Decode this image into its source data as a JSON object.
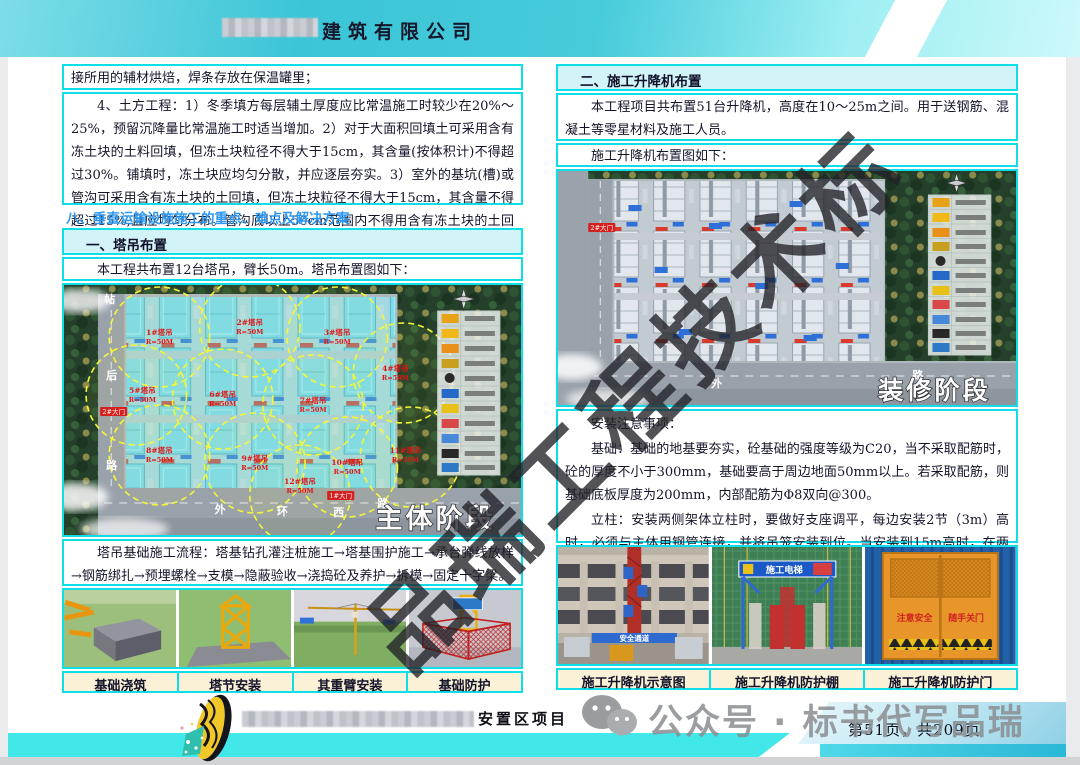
{
  "header": {
    "company": "建筑有限公司"
  },
  "watermarks": {
    "diagonal": "品瑞工程技术标",
    "wechat": "公众号 · 标书代写品瑞"
  },
  "footer": {
    "project": "安置区项目",
    "page_info": "第51页，共209页"
  },
  "left_page": {
    "para_weld": "接所用的辅材烘焙，焊条存放在保温罐里；",
    "para_earthwork": "4、土方工程：1）冬季填方每层辅土厚度应比常温施工时较少在20%～25%，预留沉降量比常温施工时适当增加。2）对于大面积回填土可采用含有冻土块的土料回填，但冻土块粒径不得大于15cm，其含量(按体积计)不得超过30%。铺填时，冻土块应均匀分散，并应逐层夯实。3）室外的基坑(槽)或管沟可采用含有冻土块的土回填，但冻土块粒径不得大于15cm，其含量不得超过15%,且应均匀分布。管沟底以上50cm范围内不得用含有冻土块的土回填。",
    "chapter_heading": "八、垂直运输设施施工的重点、难点及解决方案",
    "section_title": "一、塔吊布置",
    "section_intro": "本工程共布置12台塔吊，臂长50m。塔吊布置图如下：",
    "flow_text": "塔吊基础施工流程：塔基钻孔灌注桩施工→塔基围护施工→承台弹线放样→钢筋绑扎→预埋螺栓→支模→隐蔽验收→浇捣砼及养护→拆模→固定十字梁。",
    "photo_captions": [
      "基础浇筑",
      "塔节安装",
      "其重臂安装",
      "基础防护"
    ],
    "plan": {
      "stage_label": "主体阶段",
      "crane_radius": "R=50M",
      "cranes": [
        "1#塔吊",
        "2#塔吊",
        "3#塔吊",
        "4#塔吊",
        "5#塔吊",
        "6#塔吊",
        "7#塔吊",
        "8#塔吊",
        "9#塔吊",
        "10#塔吊",
        "11#塔吊",
        "12#塔吊"
      ],
      "gates": [
        "2#大门",
        "1#大门"
      ],
      "roads": {
        "r1": "帖",
        "r2": "后",
        "r3": "路",
        "r4": "外",
        "r5": "环",
        "r6": "西",
        "r7": "路"
      }
    }
  },
  "right_page": {
    "section_title": "二、施工升降机布置",
    "section_intro": "本工程项目共布置51台升降机，高度在10～25m之间。用于送钢筋、混凝土等零星材料及施工人员。",
    "plan_caption": "施工升降机布置图如下：",
    "notes_title": "安装注意事项：",
    "note_foundation": "基础：基础的地基要夯实，砼基础的强度等级为C20，当不采取配筋时，砼的厚度不小于300mm，基础要高于周边地面50mm以上。若采取配筋，则基础底板厚度为200mm，内部配筋为Φ8双向@300。",
    "note_column": "立柱：安装两侧架体立柱时，要做好支座调平，每边安装2节（3m）高时，必须与主体用钢管连接，并将吊笼安装到位。当安装到15m高时，在两侧立柱间要采用钢管拉接一道，同时，与主体结构拉接的钢管则要安装成八字型。",
    "photo_captions": [
      "施工升降机示意图",
      "施工升降机防护棚",
      "施工升降机防护门"
    ],
    "photo_texts": {
      "sign_passage": "安全通道",
      "sign_elevator": "施工电梯",
      "door_left": "注意安全",
      "door_right": "随手关门"
    },
    "plan": {
      "stage_label": "装修阶段",
      "gate": "2#大门",
      "roads": {
        "r1": "外",
        "r2": "路"
      }
    }
  }
}
